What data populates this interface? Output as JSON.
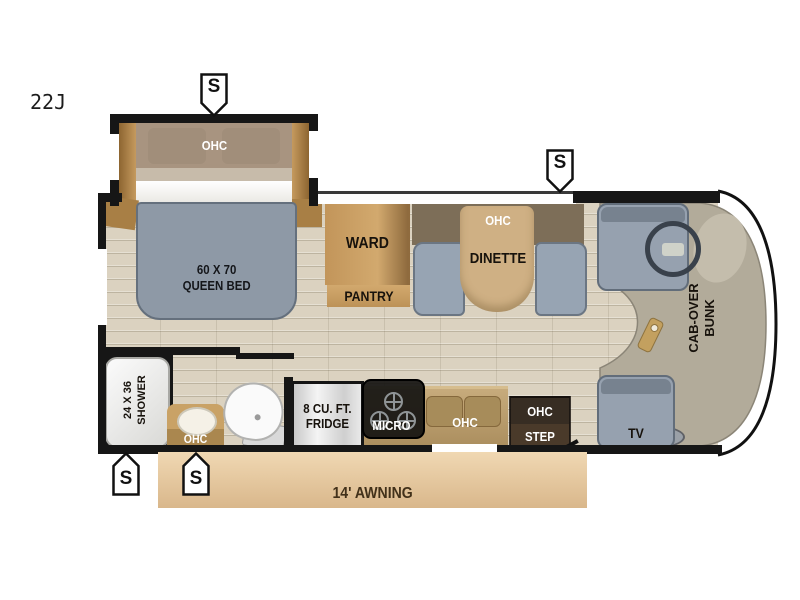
{
  "model": "22J",
  "markers": {
    "speaker": "S"
  },
  "bedroom": {
    "ohc": "OHC",
    "bed": "60 X 70\nQUEEN BED"
  },
  "storage": {
    "ward": "WARD",
    "pantry": "PANTRY"
  },
  "dinette": {
    "ohc": "OHC",
    "label": "DINETTE"
  },
  "bathroom": {
    "shower": "24 X 36\nSHOWER",
    "vanity_ohc": "OHC"
  },
  "kitchen": {
    "fridge": "8 CU. FT.\nFRIDGE",
    "micro": "MICRO",
    "sink_ohc": "OHC",
    "step": "OHC\nSTEP"
  },
  "cab": {
    "bunk": "CAB-OVER\nBUNK",
    "tv": "TV"
  },
  "exterior": {
    "awning": "14' AWNING"
  },
  "colors": {
    "wall": "#161616",
    "floor": "#dbd2c0",
    "bed": "#8e99a6",
    "bench": "#97a4b3",
    "table": "#cfb084",
    "cabinet": "#c49a62",
    "counter": "#b59a6b",
    "ohc_band": "#7d6e58",
    "cab_area": "#b2ab9a",
    "awning": "#e9cda6",
    "step": "#3a2f24"
  }
}
